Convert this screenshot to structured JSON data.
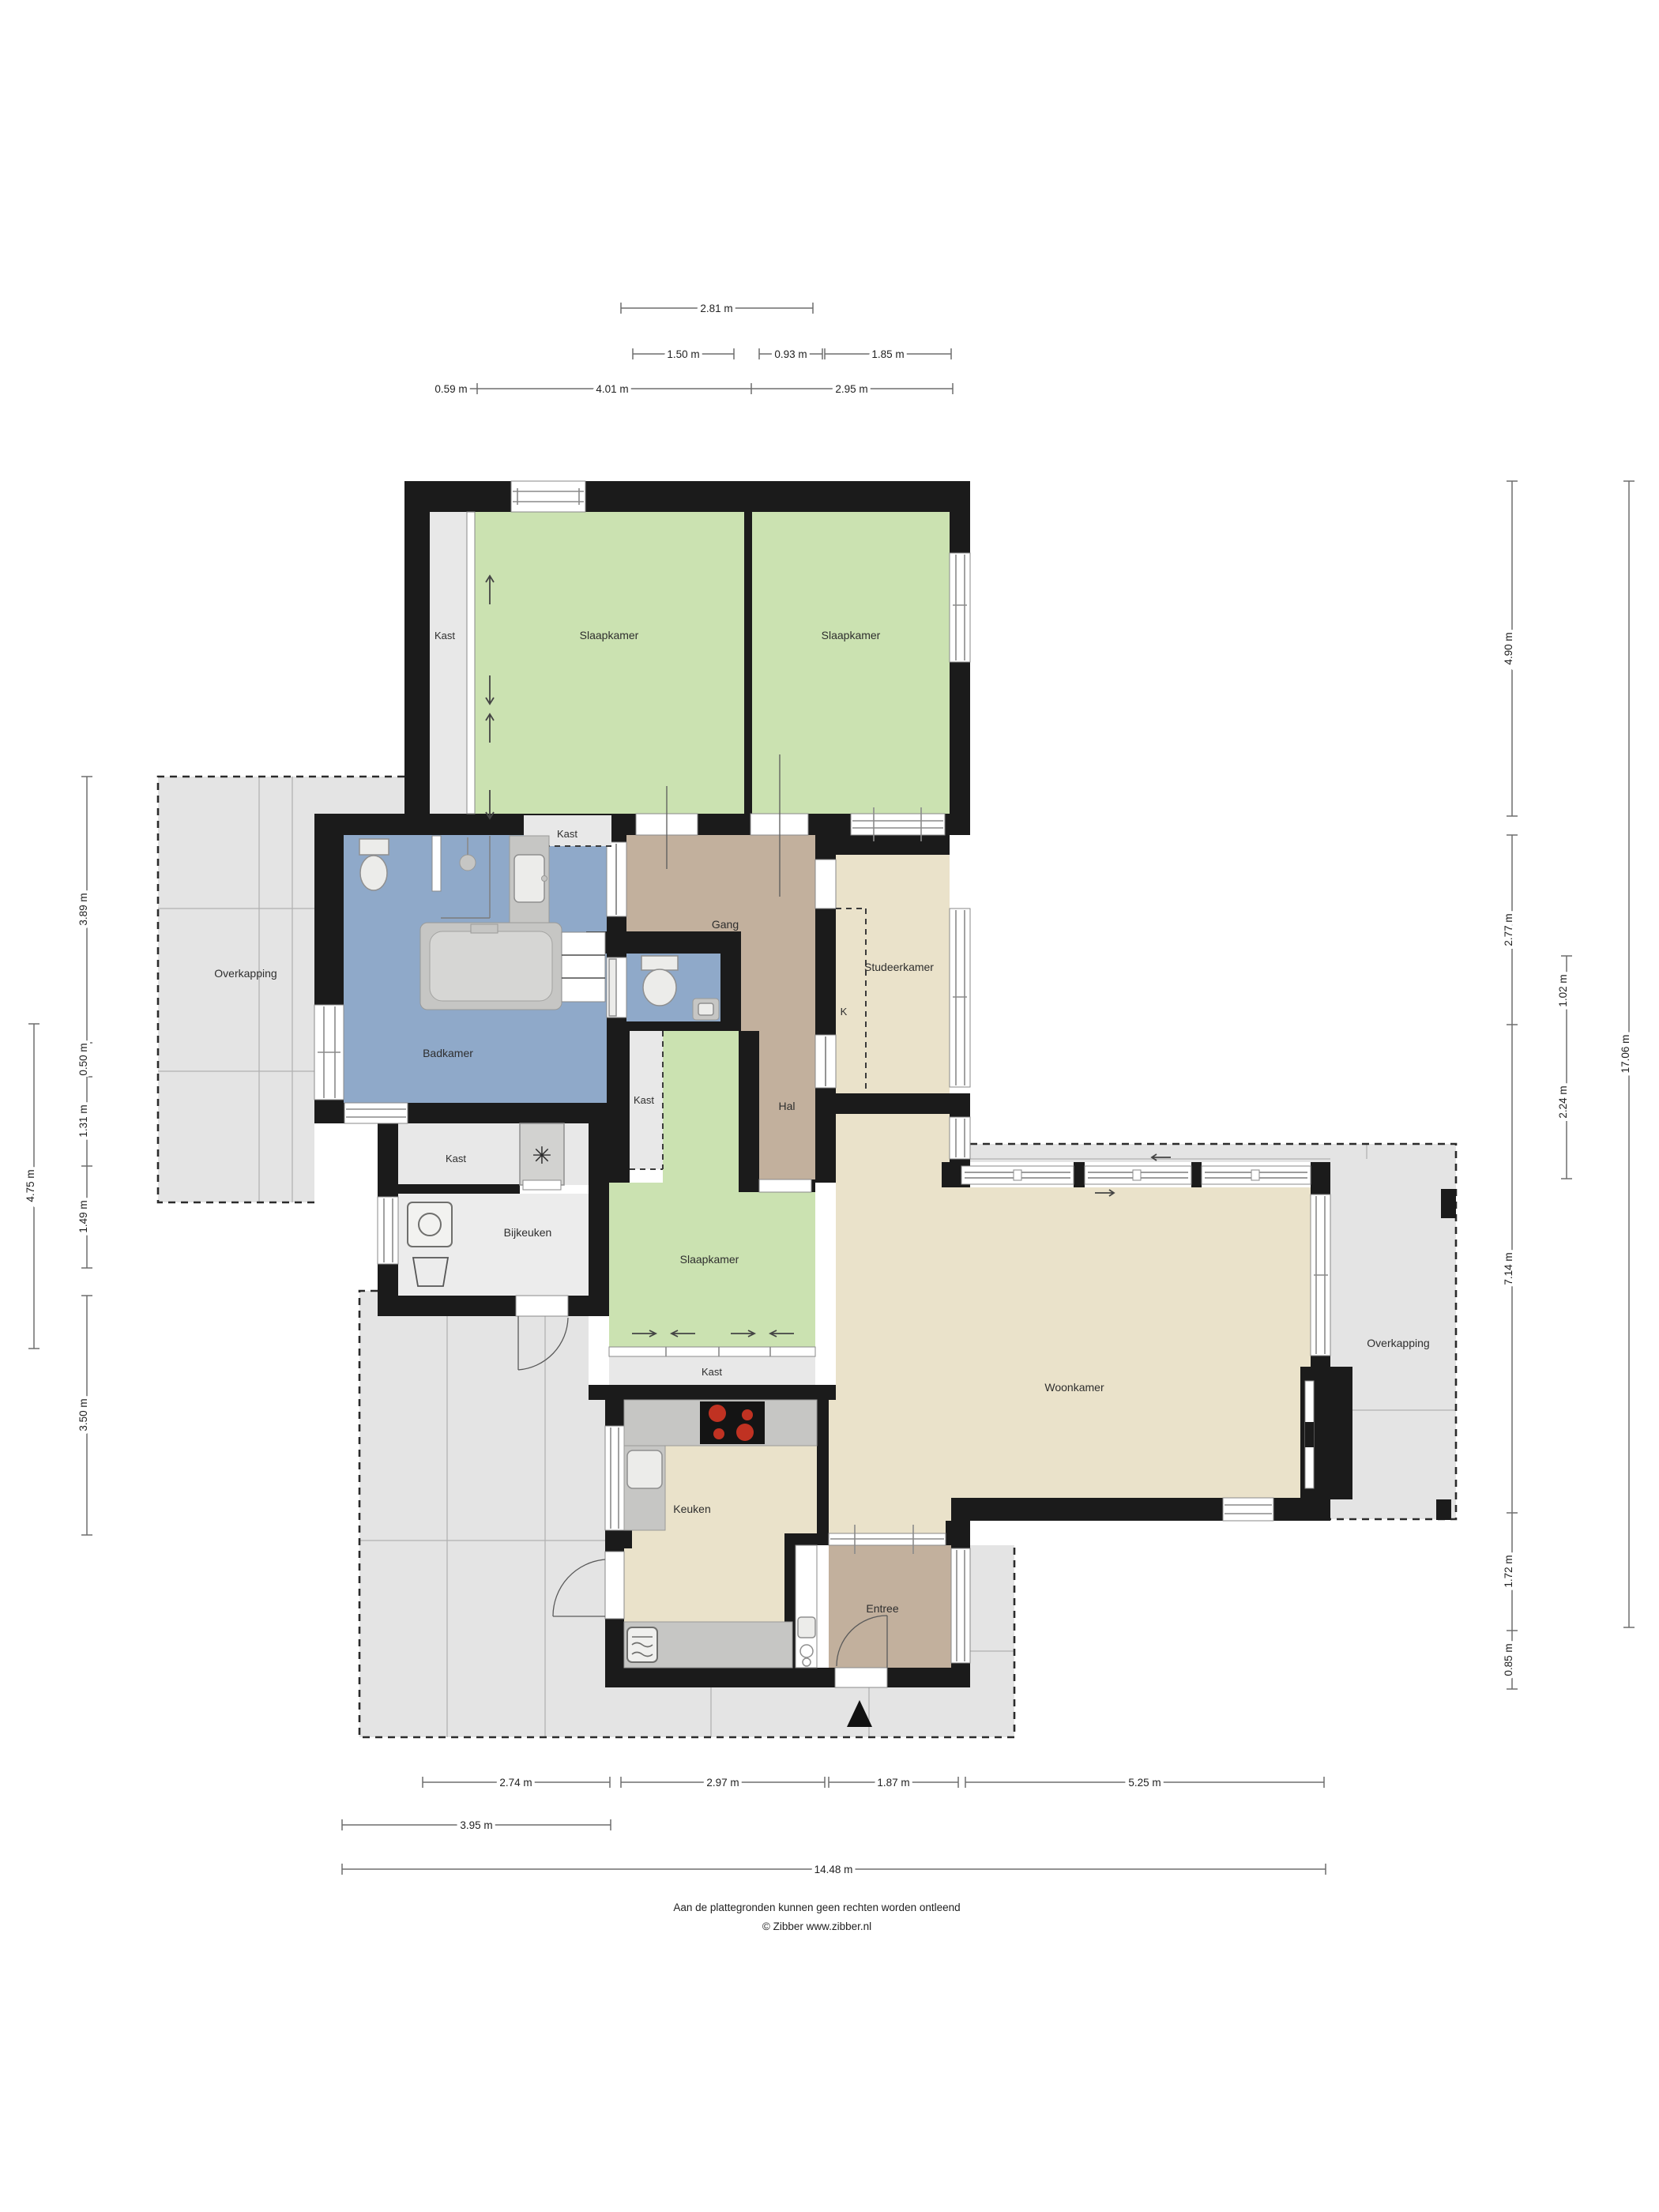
{
  "rooms": {
    "kast_bedroom_strip": "Kast",
    "slaapkamer_1": "Slaapkamer",
    "slaapkamer_2": "Slaapkamer",
    "kast_top_niche": "Kast",
    "gang": "Gang",
    "studeerkamer": "Studeerkamer",
    "k_closet": "K",
    "badkamer": "Badkamer",
    "hal": "Hal",
    "kast_hal_strip": "Kast",
    "slaapkamer_3": "Slaapkamer",
    "kast_utility": "Kast",
    "bijkeuken": "Bijkeuken",
    "kast_sliding": "Kast",
    "woonkamer": "Woonkamer",
    "keuken": "Keuken",
    "entree": "Entree",
    "overkapping_left": "Overkapping",
    "overkapping_right": "Overkapping"
  },
  "icons": {
    "ventilation_fan": "✳"
  },
  "dims": {
    "t_281": "2.81 m",
    "t_150": "1.50 m",
    "t_093": "0.93 m",
    "t_185": "1.85 m",
    "t_059": "0.59 m",
    "t_401": "4.01 m",
    "t_295": "2.95 m",
    "b_274": "2.74 m",
    "b_297": "2.97 m",
    "b_187": "1.87 m",
    "b_525": "5.25 m",
    "b_395": "3.95 m",
    "b_1448": "14.48 m",
    "l_389": "3.89 m",
    "l_050": "0.50 m",
    "l_131": "1.31 m",
    "l_149": "1.49 m",
    "l_350": "3.50 m",
    "l_475": "4.75 m",
    "r_490": "4.90 m",
    "r_277": "2.77 m",
    "r_714": "7.14 m",
    "r_172": "1.72 m",
    "r_085": "0.85 m",
    "r_102": "1.02 m",
    "r_224": "2.24 m",
    "r_1706": "17.06 m"
  },
  "footer": {
    "line1": "Aan de plattegronden kunnen geen rechten worden ontleend",
    "line2": "© Zibber www.zibber.nl"
  }
}
